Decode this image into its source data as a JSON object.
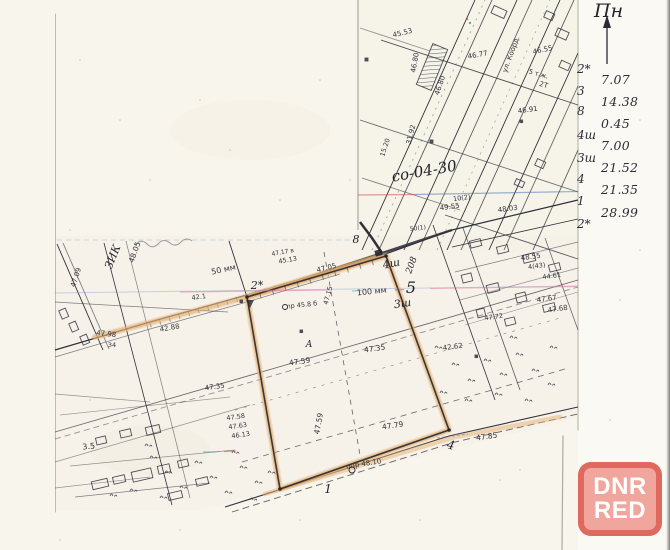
{
  "compass": {
    "label": "Пн"
  },
  "survey_panel": {
    "points": [
      "2*",
      "3",
      "8",
      "4ш",
      "3ш",
      "4",
      "1",
      "2*"
    ],
    "distances": [
      "7.07",
      "14.38",
      "0.45",
      "7.00",
      "21.52",
      "21.35",
      "28.99"
    ]
  },
  "watermark": {
    "line1": "DNR",
    "line2": "RED"
  },
  "colors": {
    "paper": "#f8f5ed",
    "ink": "#31313a",
    "parcel_highlight": "#e4b172",
    "watermark_red": "#dc5f55",
    "scan_line_blue": "#3c6ebe",
    "scan_line_pink": "#e66e96"
  },
  "map": {
    "parcel_code_note": "со-04-30",
    "labels": [
      {
        "t": "45.53",
        "x": 403,
        "y": 35,
        "r": -14,
        "s": 7
      },
      {
        "t": "46.80",
        "x": 417,
        "y": 63,
        "r": -80,
        "s": 7
      },
      {
        "t": "46.80",
        "x": 442,
        "y": 86,
        "r": -72,
        "s": 7
      },
      {
        "t": "46.77",
        "x": 478,
        "y": 57,
        "r": -10,
        "s": 7
      },
      {
        "t": "46.55",
        "x": 543,
        "y": 52,
        "r": -12,
        "s": 7
      },
      {
        "t": "5 т.ж.",
        "x": 538,
        "y": 76,
        "r": 16,
        "s": 6.5
      },
      {
        "t": "2Т",
        "x": 543,
        "y": 87,
        "r": 16,
        "s": 7
      },
      {
        "t": "46.91",
        "x": 528,
        "y": 112,
        "r": -8,
        "s": 7
      },
      {
        "t": "ул. Коорд.",
        "x": 513,
        "y": 55,
        "r": -70,
        "s": 7
      },
      {
        "t": "31.92",
        "x": 413,
        "y": 135,
        "r": -76,
        "s": 7
      },
      {
        "t": "15.20",
        "x": 387,
        "y": 148,
        "r": -72,
        "s": 6.5
      },
      {
        "t": "со-04-30",
        "x": 425,
        "y": 176,
        "r": -10,
        "s": 15,
        "c": "h"
      },
      {
        "t": "50(1)",
        "x": 418,
        "y": 230,
        "r": -6,
        "s": 6
      },
      {
        "t": "10(2)",
        "x": 462,
        "y": 200,
        "r": -8,
        "s": 6.5
      },
      {
        "t": "49.55",
        "x": 450,
        "y": 209,
        "r": -8,
        "s": 7
      },
      {
        "t": "48.03",
        "x": 508,
        "y": 211,
        "r": -8,
        "s": 7
      },
      {
        "t": "ЗИК",
        "x": 116,
        "y": 258,
        "r": -68,
        "s": 11,
        "c": "h"
      },
      {
        "t": "48.05",
        "x": 137,
        "y": 253,
        "r": -70,
        "s": 7.5
      },
      {
        "t": "47.09",
        "x": 78,
        "y": 278,
        "r": -72,
        "s": 7
      },
      {
        "t": "42.88",
        "x": 170,
        "y": 330,
        "r": -10,
        "s": 7
      },
      {
        "t": "42.1",
        "x": 199,
        "y": 299,
        "r": -8,
        "s": 6.5
      },
      {
        "t": "50 мм",
        "x": 224,
        "y": 272,
        "r": -12,
        "s": 8
      },
      {
        "t": "100 мм",
        "x": 372,
        "y": 294,
        "r": -6,
        "s": 8
      },
      {
        "t": "47.17 в",
        "x": 283,
        "y": 254,
        "r": -10,
        "s": 6
      },
      {
        "t": "45.13",
        "x": 288,
        "y": 262,
        "r": -10,
        "s": 6.5
      },
      {
        "t": "47.05",
        "x": 327,
        "y": 270,
        "r": -14,
        "s": 7
      },
      {
        "t": "47.15",
        "x": 330,
        "y": 296,
        "r": -75,
        "s": 6.5
      },
      {
        "t": "пр 45.8 б",
        "x": 302,
        "y": 307,
        "r": -6,
        "s": 6.5
      },
      {
        "t": "47.98",
        "x": 106,
        "y": 336,
        "r": 6,
        "s": 7
      },
      {
        "t": "34",
        "x": 112,
        "y": 347,
        "r": 0,
        "s": 6.5
      },
      {
        "t": "47.35",
        "x": 215,
        "y": 389,
        "r": -8,
        "s": 7
      },
      {
        "t": "3.5",
        "x": 89,
        "y": 449,
        "r": -6,
        "s": 8
      },
      {
        "t": "47.58",
        "x": 236,
        "y": 419,
        "r": -8,
        "s": 6.5
      },
      {
        "t": "47.63",
        "x": 238,
        "y": 428,
        "r": -8,
        "s": 6.5
      },
      {
        "t": "46.13",
        "x": 241,
        "y": 437,
        "r": -8,
        "s": 6.5
      },
      {
        "t": "47.59",
        "x": 300,
        "y": 364,
        "r": -8,
        "s": 7.5
      },
      {
        "t": "47.35",
        "x": 375,
        "y": 351,
        "r": -8,
        "s": 7.5
      },
      {
        "t": "47.59",
        "x": 321,
        "y": 424,
        "r": -80,
        "s": 7.5
      },
      {
        "t": "47.79",
        "x": 393,
        "y": 428,
        "r": -8,
        "s": 7.5
      },
      {
        "t": "42.62",
        "x": 453,
        "y": 349,
        "r": -8,
        "s": 7
      },
      {
        "t": "48.55",
        "x": 531,
        "y": 259,
        "r": -8,
        "s": 7
      },
      {
        "t": "4(43)",
        "x": 537,
        "y": 268,
        "r": -8,
        "s": 6.5
      },
      {
        "t": "44.61",
        "x": 552,
        "y": 278,
        "r": -8,
        "s": 6.5
      },
      {
        "t": "47.67",
        "x": 547,
        "y": 301,
        "r": -8,
        "s": 7
      },
      {
        "t": "47.68",
        "x": 558,
        "y": 311,
        "r": -8,
        "s": 7
      },
      {
        "t": "47.72",
        "x": 494,
        "y": 319,
        "r": -8,
        "s": 6.5
      },
      {
        "t": "47.85",
        "x": 487,
        "y": 439,
        "r": -8,
        "s": 7.5
      },
      {
        "t": "опр 48.10",
        "x": 364,
        "y": 466,
        "r": -9,
        "s": 7
      },
      {
        "t": "2*",
        "x": 257,
        "y": 289,
        "r": 0,
        "s": 11,
        "c": "h"
      },
      {
        "t": "8",
        "x": 356,
        "y": 243,
        "r": 0,
        "s": 11,
        "c": "h"
      },
      {
        "t": "4ш",
        "x": 392,
        "y": 267,
        "r": -12,
        "s": 11,
        "c": "h"
      },
      {
        "t": "208",
        "x": 414,
        "y": 266,
        "r": -70,
        "s": 9,
        "c": "h"
      },
      {
        "t": "5",
        "x": 411,
        "y": 293,
        "r": 0,
        "s": 16,
        "c": "h"
      },
      {
        "t": "3ш",
        "x": 403,
        "y": 307,
        "r": -8,
        "s": 11,
        "c": "h"
      },
      {
        "t": "А",
        "x": 309,
        "y": 347,
        "r": 0,
        "s": 9,
        "c": "h"
      },
      {
        "t": "1",
        "x": 328,
        "y": 493,
        "r": 0,
        "s": 12,
        "c": "h"
      },
      {
        "t": "4",
        "x": 450,
        "y": 449,
        "r": 12,
        "s": 12,
        "c": "h"
      }
    ]
  }
}
